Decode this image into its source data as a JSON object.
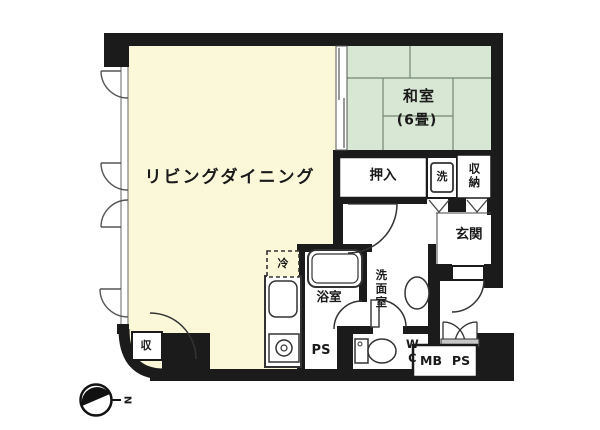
{
  "labels": {
    "living_dining": "リビングダイニング",
    "japanese_room": "和室",
    "japanese_room_size": "(6畳)",
    "oshiire_closet": "押入",
    "storage": "収納",
    "entrance": "玄関",
    "bathroom": "浴室",
    "washroom": "洗面室",
    "toilet": "WC",
    "small_storage": "収",
    "refrigerator": "冷",
    "washing_machine": "洗",
    "pipe_space_1": "PS",
    "meter_box": "MB",
    "pipe_space_2": "PS",
    "compass_north": "N"
  },
  "colors": {
    "living_floor": "#fbf8da",
    "tatami_floor": "#d7e7d4",
    "wall": "#1b1b1b"
  }
}
